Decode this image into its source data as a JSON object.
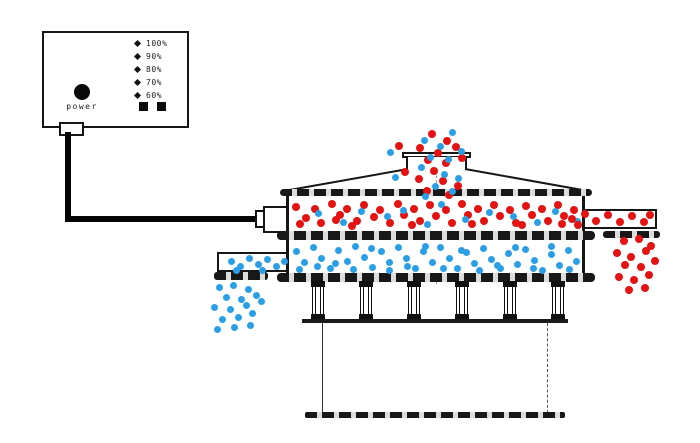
{
  "controller": {
    "power_label": "power",
    "speed_levels": [
      "100%",
      "90%",
      "80%",
      "70%",
      "60%"
    ]
  },
  "colors": {
    "coarse_particles": "#e51212",
    "fine_particles": "#2b9fe5",
    "line": "#161616"
  },
  "particles": {
    "groups": [
      {
        "name": "inlet-stream-coarse",
        "color": "#e51212",
        "size": 8,
        "points": [
          [
            432,
            134
          ],
          [
            447,
            141
          ],
          [
            399,
            146
          ],
          [
            420,
            148
          ],
          [
            438,
            153
          ],
          [
            456,
            147
          ],
          [
            428,
            160
          ],
          [
            446,
            163
          ],
          [
            405,
            172
          ],
          [
            434,
            171
          ],
          [
            419,
            179
          ],
          [
            443,
            181
          ],
          [
            458,
            186
          ],
          [
            427,
            191
          ],
          [
            449,
            195
          ],
          [
            462,
            158
          ]
        ]
      },
      {
        "name": "inlet-stream-fine",
        "color": "#2b9fe5",
        "size": 7,
        "points": [
          [
            452,
            132
          ],
          [
            424,
            140
          ],
          [
            440,
            146
          ],
          [
            461,
            151
          ],
          [
            390,
            152
          ],
          [
            430,
            157
          ],
          [
            448,
            159
          ],
          [
            421,
            167
          ],
          [
            395,
            177
          ],
          [
            444,
            174
          ],
          [
            458,
            178
          ],
          [
            435,
            186
          ],
          [
            425,
            196
          ],
          [
            452,
            191
          ]
        ]
      },
      {
        "name": "upper-deck-coarse",
        "color": "#e51212",
        "size": 8,
        "points": [
          [
            296,
            207
          ],
          [
            306,
            218
          ],
          [
            315,
            209
          ],
          [
            321,
            223
          ],
          [
            332,
            204
          ],
          [
            340,
            215
          ],
          [
            347,
            209
          ],
          [
            357,
            221
          ],
          [
            364,
            205
          ],
          [
            374,
            217
          ],
          [
            380,
            210
          ],
          [
            390,
            223
          ],
          [
            398,
            204
          ],
          [
            404,
            215
          ],
          [
            414,
            209
          ],
          [
            420,
            221
          ],
          [
            430,
            205
          ],
          [
            436,
            216
          ],
          [
            446,
            210
          ],
          [
            452,
            223
          ],
          [
            462,
            204
          ],
          [
            468,
            215
          ],
          [
            478,
            209
          ],
          [
            484,
            221
          ],
          [
            494,
            205
          ],
          [
            500,
            216
          ],
          [
            510,
            210
          ],
          [
            516,
            223
          ],
          [
            526,
            206
          ],
          [
            532,
            215
          ],
          [
            542,
            209
          ],
          [
            548,
            221
          ],
          [
            558,
            205
          ],
          [
            564,
            216
          ],
          [
            574,
            210
          ],
          [
            300,
            224
          ],
          [
            352,
            226
          ],
          [
            412,
            225
          ],
          [
            472,
            224
          ],
          [
            522,
            225
          ],
          [
            562,
            224
          ],
          [
            336,
            220
          ]
        ]
      },
      {
        "name": "upper-deck-fine",
        "color": "#2b9fe5",
        "size": 7,
        "points": [
          [
            318,
            213
          ],
          [
            343,
            222
          ],
          [
            361,
            211
          ],
          [
            387,
            216
          ],
          [
            403,
            210
          ],
          [
            427,
            224
          ],
          [
            441,
            204
          ],
          [
            465,
            219
          ],
          [
            489,
            212
          ],
          [
            513,
            216
          ],
          [
            537,
            222
          ],
          [
            555,
            211
          ],
          [
            577,
            221
          ]
        ]
      },
      {
        "name": "right-outlet-coarse",
        "color": "#e51212",
        "size": 8,
        "points": [
          [
            572,
            219
          ],
          [
            585,
            214
          ],
          [
            596,
            221
          ],
          [
            608,
            215
          ],
          [
            620,
            222
          ],
          [
            632,
            216
          ],
          [
            644,
            222
          ],
          [
            650,
            215
          ],
          [
            578,
            225
          ]
        ]
      },
      {
        "name": "right-discharge-coarse",
        "color": "#e51212",
        "size": 8,
        "points": [
          [
            624,
            241
          ],
          [
            639,
            239
          ],
          [
            651,
            246
          ],
          [
            617,
            253
          ],
          [
            631,
            257
          ],
          [
            646,
            251
          ],
          [
            625,
            265
          ],
          [
            641,
            267
          ],
          [
            655,
            261
          ],
          [
            619,
            277
          ],
          [
            634,
            280
          ],
          [
            649,
            275
          ],
          [
            629,
            290
          ],
          [
            645,
            288
          ]
        ]
      },
      {
        "name": "lower-deck-fine",
        "color": "#2b9fe5",
        "size": 7,
        "points": [
          [
            296,
            251
          ],
          [
            304,
            262
          ],
          [
            313,
            247
          ],
          [
            321,
            258
          ],
          [
            330,
            268
          ],
          [
            338,
            250
          ],
          [
            347,
            261
          ],
          [
            355,
            246
          ],
          [
            364,
            257
          ],
          [
            372,
            267
          ],
          [
            381,
            251
          ],
          [
            389,
            262
          ],
          [
            398,
            247
          ],
          [
            406,
            258
          ],
          [
            415,
            268
          ],
          [
            423,
            251
          ],
          [
            432,
            262
          ],
          [
            440,
            247
          ],
          [
            449,
            258
          ],
          [
            457,
            268
          ],
          [
            466,
            252
          ],
          [
            474,
            263
          ],
          [
            483,
            248
          ],
          [
            491,
            259
          ],
          [
            500,
            268
          ],
          [
            508,
            253
          ],
          [
            517,
            264
          ],
          [
            525,
            249
          ],
          [
            534,
            260
          ],
          [
            542,
            270
          ],
          [
            551,
            254
          ],
          [
            559,
            265
          ],
          [
            568,
            250
          ],
          [
            576,
            261
          ],
          [
            299,
            269
          ],
          [
            317,
            266
          ],
          [
            335,
            263
          ],
          [
            353,
            269
          ],
          [
            371,
            248
          ],
          [
            389,
            270
          ],
          [
            407,
            266
          ],
          [
            425,
            246
          ],
          [
            443,
            268
          ],
          [
            461,
            250
          ],
          [
            479,
            270
          ],
          [
            497,
            265
          ],
          [
            515,
            247
          ],
          [
            533,
            268
          ],
          [
            551,
            246
          ],
          [
            569,
            269
          ]
        ]
      },
      {
        "name": "left-outlet-fine",
        "color": "#2b9fe5",
        "size": 7,
        "points": [
          [
            231,
            261
          ],
          [
            240,
            266
          ],
          [
            249,
            258
          ],
          [
            258,
            264
          ],
          [
            267,
            259
          ],
          [
            276,
            266
          ],
          [
            284,
            261
          ],
          [
            236,
            270
          ],
          [
            262,
            270
          ]
        ]
      },
      {
        "name": "left-discharge-fine",
        "color": "#2b9fe5",
        "size": 7,
        "points": [
          [
            219,
            287
          ],
          [
            233,
            285
          ],
          [
            248,
            289
          ],
          [
            226,
            297
          ],
          [
            241,
            299
          ],
          [
            256,
            295
          ],
          [
            214,
            307
          ],
          [
            230,
            309
          ],
          [
            246,
            305
          ],
          [
            261,
            301
          ],
          [
            222,
            319
          ],
          [
            238,
            317
          ],
          [
            252,
            313
          ],
          [
            217,
            329
          ],
          [
            234,
            327
          ],
          [
            250,
            325
          ]
        ]
      }
    ]
  }
}
